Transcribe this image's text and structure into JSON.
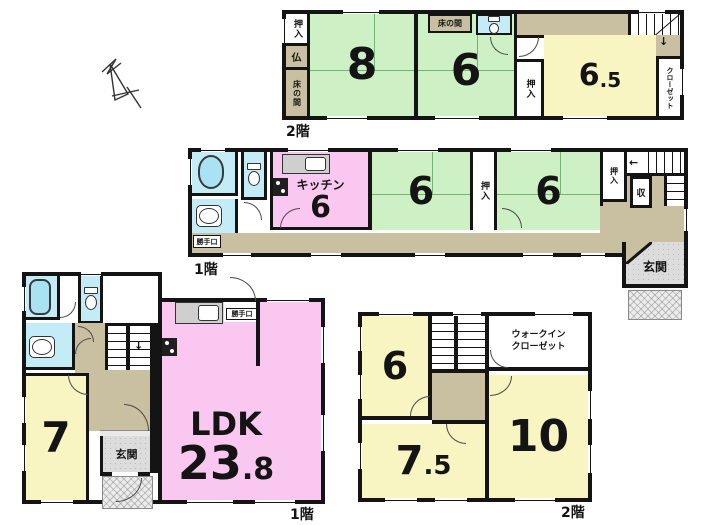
{
  "colors": {
    "tatami_green": "#cdf0c5",
    "room_yellow": "#f8f5c2",
    "kitchen_pink": "#f9c7ef",
    "sanitary_cyan": "#c3ecf6",
    "hall_tan": "#c9c0a2",
    "entry_gray": "#dcdcdc",
    "wall": "#141414"
  },
  "plan_2f_top": {
    "floor_label": "2階",
    "closet_left": "押入",
    "butsudan": "仏",
    "tokonoma_left": "床の間",
    "room8": "8",
    "tokonoma_top": "床の間",
    "room6": "6",
    "closet_mid": "押入",
    "room65_main": "6",
    "room65_frac": ".5",
    "closet_right": "クローゼット",
    "stair_arrow": "↓"
  },
  "plan_1f_mid": {
    "floor_label": "1階",
    "back_door": "勝手口",
    "kitchen_name": "キッチン",
    "kitchen_size": "6",
    "room6_left": "6",
    "closet_a": "押入",
    "room6_right": "6",
    "closet_b": "押入",
    "storage": "収",
    "entrance": "玄関",
    "stair_arrow": "←"
  },
  "plan_1f_main": {
    "floor_label": "1階",
    "room7": "7",
    "entrance": "玄関",
    "back_door": "勝手口",
    "ldk_name": "LDK",
    "ldk_main": "23",
    "ldk_frac": ".8",
    "stair_arrow": "↓"
  },
  "plan_2f_main": {
    "floor_label": "2階",
    "room6": "6",
    "wic_line1": "ウォークイン",
    "wic_line2": "クローゼット",
    "room75_main": "7",
    "room75_frac": ".5",
    "room10": "10"
  }
}
